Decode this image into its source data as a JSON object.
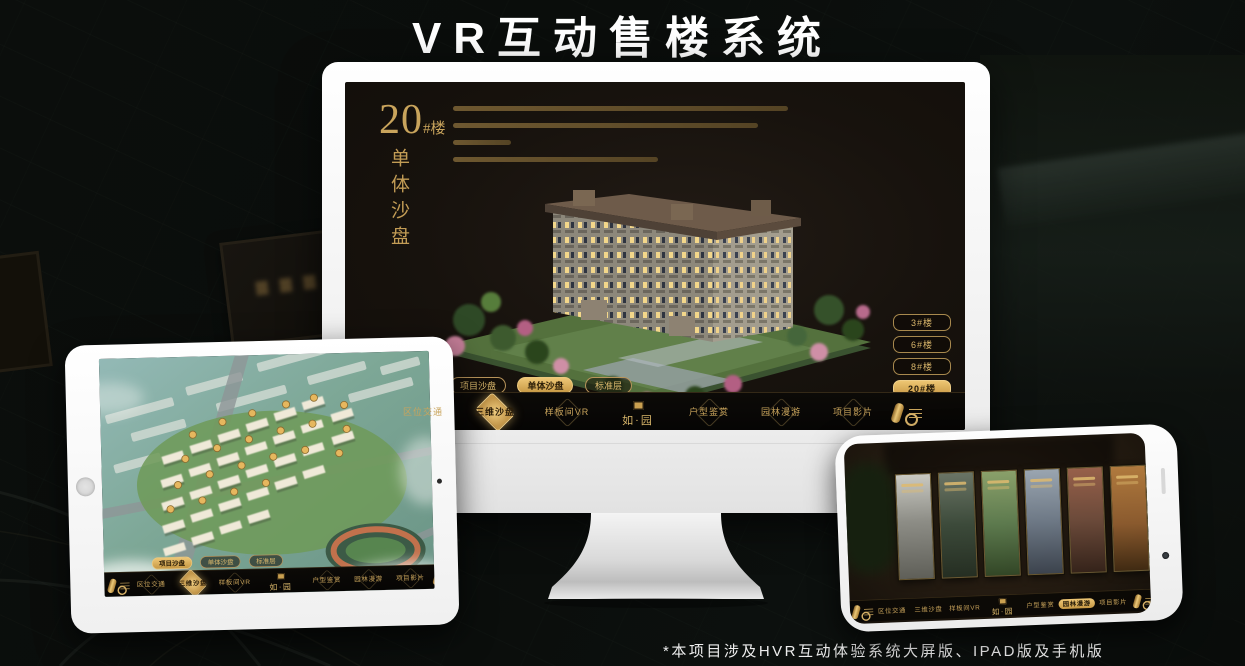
{
  "page": {
    "title": "VR互动售楼系统",
    "footnote": "*本项目涉及HVR互动体验系统大屏版、IPAD版及手机版"
  },
  "colors": {
    "gold_accent": "#d3ab62",
    "gold_active_bg": "#e5bd6d",
    "screen_bg": "#17120d",
    "headline_color": "#ffffff"
  },
  "nav": {
    "logo": "如·园",
    "items": [
      "区位交通",
      "三维沙盘",
      "样板间VR",
      "户型鉴赏",
      "园林漫游",
      "项目影片"
    ]
  },
  "sub_tabs": [
    "项目沙盘",
    "单体沙盘",
    "标准层"
  ],
  "monitor": {
    "building_no": "20",
    "building_no_suffix": "#楼",
    "building_title_vertical": "单体沙盘",
    "floor_buttons": [
      "3#楼",
      "6#楼",
      "8#楼",
      "20#楼"
    ],
    "active_floor": "20#楼",
    "active_sub_tab": "单体沙盘",
    "active_nav": "三维沙盘"
  },
  "tablet": {
    "active_sub_tab": "项目沙盘",
    "active_nav": "三维沙盘"
  },
  "phone": {
    "active_nav": "园林漫游"
  },
  "icons": {
    "scroll": "scroll-icon",
    "seal": "seal-logo-icon",
    "home": "home-button",
    "camera": "camera-icon"
  }
}
